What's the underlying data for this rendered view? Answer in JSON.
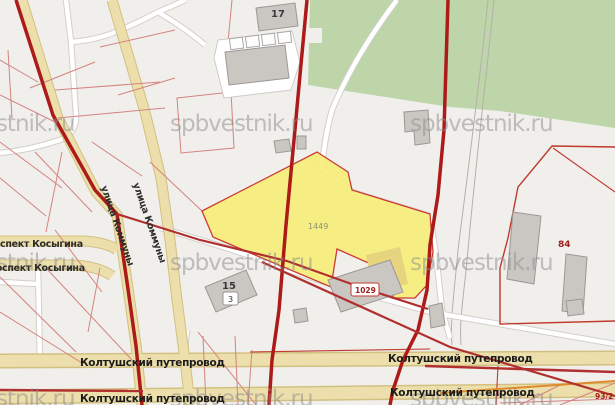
{
  "map_viewer": {
    "watermark_text": "spbvestnik.ru",
    "streets": {
      "kommuny": "улица Коммуны",
      "kosygina": "проспект Косыгина",
      "koltushsky": "Колтушский путепровод"
    },
    "parcels": {
      "main_parcel_number": "1449",
      "parcel_84": "84",
      "parcel_93_2": "93/2"
    },
    "buildings": {
      "building_17": "17",
      "building_15": "15",
      "building_15_address_plate": "3",
      "building_1029": "1029"
    },
    "colors": {
      "background": "#f1efec",
      "forest_green": "#bdd5a8",
      "highlight_parcel_yellow": "#f6ee78",
      "parcel_outline_red": "#cc3b35",
      "road_tan": "#ecdfab",
      "main_road_dark_red": "#ac1a1a",
      "cadastral_line_red": "#d4837f",
      "building_gray": "#cac7c3",
      "watermark_gray": "#8e8e8e",
      "utility_orange": "#df8b2d"
    }
  }
}
